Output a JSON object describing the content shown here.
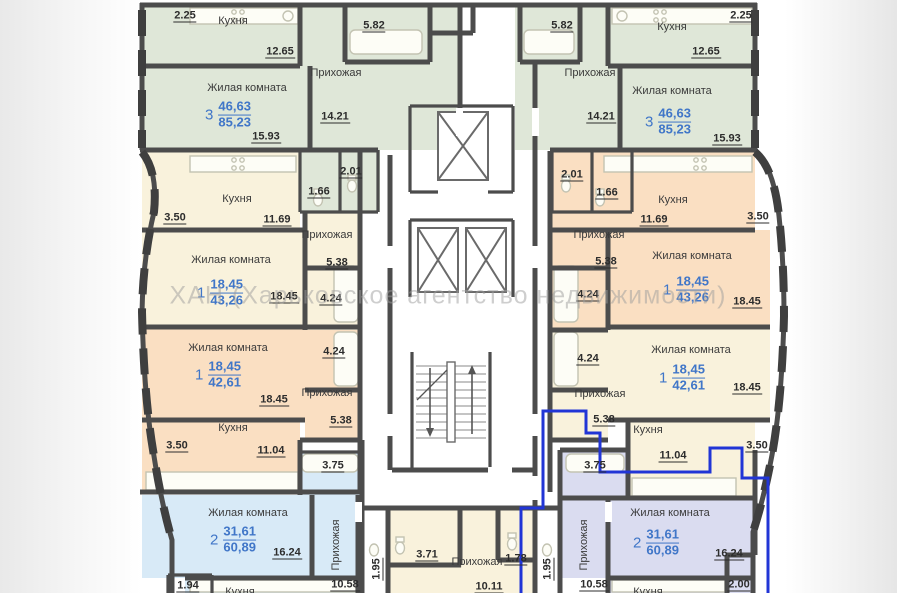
{
  "watermark": "ХАН (Харьковское агентство недвижимости)",
  "room_names": {
    "kitchen": "Кухня",
    "living": "Жилая комната",
    "hall": "Прихожая"
  },
  "apartment_types": {
    "three_room": {
      "rooms": "3",
      "living_area": "46,63",
      "total_area": "85,23"
    },
    "one_room_a": {
      "rooms": "1",
      "living_area": "18,45",
      "total_area": "43,26"
    },
    "one_room_b": {
      "rooms": "1",
      "living_area": "18,45",
      "total_area": "42,61"
    },
    "two_room": {
      "rooms": "2",
      "living_area": "31,61",
      "total_area": "60,89"
    }
  },
  "dimensions": {
    "top": {
      "balcony": "2.25",
      "kitchen": "12.65",
      "bath": "5.82",
      "hall": "14.21",
      "living": "15.93",
      "wc": "2.01",
      "lobby": "1.66"
    },
    "mid": {
      "balcony": "3.50",
      "kitchen": "11.69",
      "hall": "5.38",
      "bath": "4.24",
      "living": "18.45"
    },
    "low": {
      "balcony": "3.50",
      "kitchen": "11.04",
      "hall": "5.38",
      "bath": "4.24",
      "living": "18.45"
    },
    "bottom_left": {
      "bath": "3.75",
      "living": "16.24",
      "hall": "10.58",
      "shaft": "1.95",
      "balcony": "1.94"
    },
    "bottom_right": {
      "bath": "3.75",
      "living": "16.24",
      "hall": "10.58",
      "balcony": "2.00"
    },
    "bottom_mid": {
      "bath": "3.71",
      "hall": "10.11",
      "wc": "1.78",
      "shaft": "1.95"
    }
  },
  "colors": {
    "wall": "#4c4c4c",
    "apartment_3room_fill": "#dfe7d8",
    "apartment_1room_cream_fill": "#f9f2dc",
    "apartment_1room_peach_fill": "#fadfc2",
    "apartment_2room_blue_fill": "#d8eaf7",
    "apartment_2room_lavender_fill": "#dadcf0",
    "highlight_outline": "#2135d6",
    "area_label_text": "#4076c8"
  }
}
